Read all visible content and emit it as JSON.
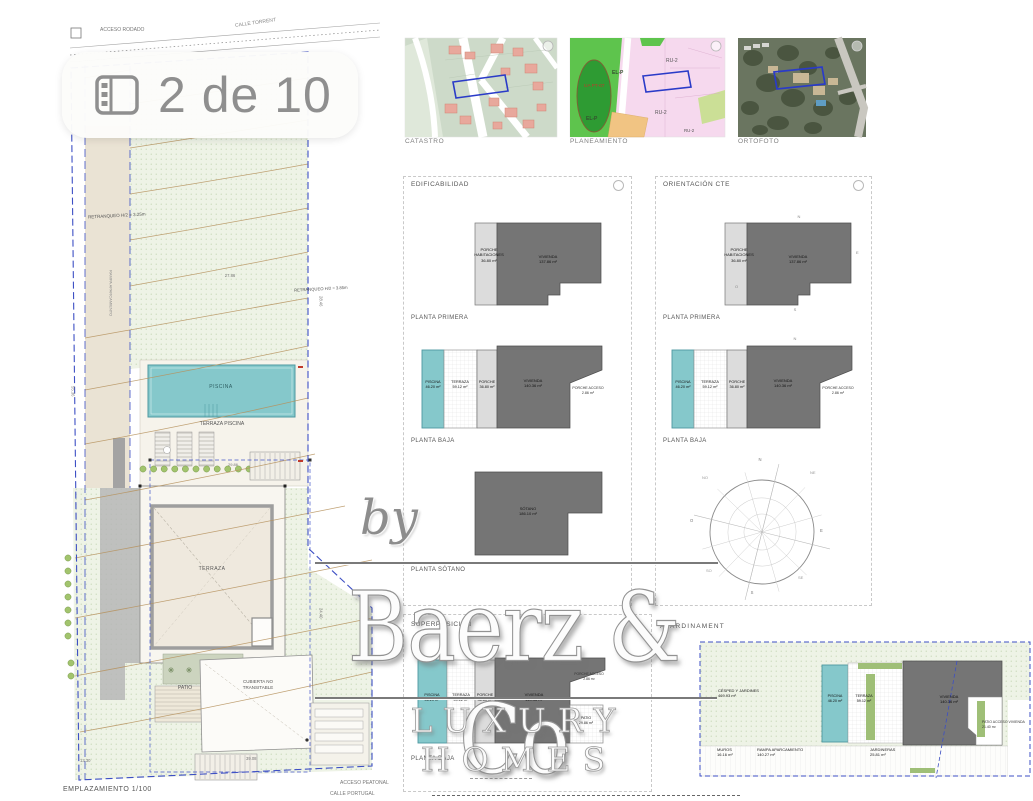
{
  "badge": {
    "label": "2 de 10"
  },
  "maps": {
    "catastro": {
      "caption": "CATASTRO"
    },
    "planeamiento": {
      "caption": "PLANEAMIENTO",
      "zones": {
        "elp1": "EL-P",
        "ua": "UA PT-07",
        "elp2": "EL-P",
        "ru1": "RU-2",
        "ru2": "RU-2",
        "ru3": "RU-2"
      }
    },
    "ortofoto": {
      "caption": "ORTOFOTO"
    }
  },
  "site": {
    "acceso_rodado": "ACCESO RODADO",
    "calle_top": "CALLE TORRENT",
    "retranqueo_left": "RETRANQUEO H/2 = 3.25m",
    "retranqueo_right": "RETRANQUEO H/2 = 3.85m",
    "rampa_note": "RAMPA APARCAMIENTO",
    "piscina": "PISCINA",
    "terraza_piscina": "TERRAZA PISCINA",
    "terraza": "TERRAZA",
    "patio": "PATIO",
    "cubierta": "CUBIERTA NO\nTRANSITABLE",
    "caption": "EMPLAZAMIENTO 1/100",
    "acceso_peatonal": "ACCESO PEATONAL",
    "calle_portugal": "CALLE PORTUGAL",
    "dims": {
      "d1": "27.86",
      "d2": "28.46",
      "d3": "24.40",
      "d4": "55.36",
      "d5": "13.30",
      "d6": "39.08",
      "d7": "29.86"
    }
  },
  "plans": {
    "pp": {
      "porche": "PORCHE\nHABITACIONES\n36.80 m²",
      "vivienda": "VIVIENDA\n137.86 m²",
      "label": "PLANTA PRIMERA"
    },
    "pb": {
      "piscina": "PISCINA\n46.20 m²",
      "terraza": "TERRAZA\n59.12 m²",
      "porche": "PORCHE\n36.80 m²",
      "vivienda": "VIVIENDA\n140.36 m²",
      "acceso": "PORCHE ACCESO\n2.86 m²",
      "label": "PLANTA BAJA"
    },
    "ps": {
      "sotano": "SÓTANO\n186.10 m²",
      "label": "PLANTA SÓTANO"
    }
  },
  "edificabilidad": {
    "title": "EDIFICABILIDAD"
  },
  "orientacion": {
    "title": "ORIENTACIÓN CTE",
    "letters": {
      "n": "N",
      "e": "E",
      "s": "S",
      "o": "O"
    },
    "compass": {
      "n": "N",
      "ne": "NE",
      "e": "E",
      "se": "SE",
      "s": "S",
      "so": "SO",
      "o": "O",
      "no": "NO"
    }
  },
  "superposicion": {
    "title": "SUPERPOSICIÓN",
    "patio": "PATIO\n29.86 m²"
  },
  "ajardinament": {
    "title": "AJARDINAMENT",
    "cesped": "CÉSPED Y JARDINES\n469.93 m²",
    "muros": "MUROS\n16.16 m²",
    "rampa": "RAMPA APARCAMIENTO\n140.27 m²",
    "piscina": "PISCINA\n46.20 m²",
    "terraza": "TERRAZA\n59.12 m²",
    "vivienda": "VIVIENDA\n140.36 m²",
    "jardineras": "JARDINERAS\n25.81 m²",
    "patio_acceso": "PATIO ACCESO VIVIENDA\n21.40 m²"
  },
  "watermark": {
    "by": "by",
    "brand": "Baerz & Co",
    "tagline": "LUXURY HOMES"
  },
  "colors": {
    "pool": "#85c8cb",
    "vivienda": "#757575",
    "porche": "#dcdcdc",
    "plot_boundary": "#3d4fc4",
    "contour": "#b6925e",
    "lawn": "#eef3e6",
    "accent_red": "#c0392b"
  }
}
